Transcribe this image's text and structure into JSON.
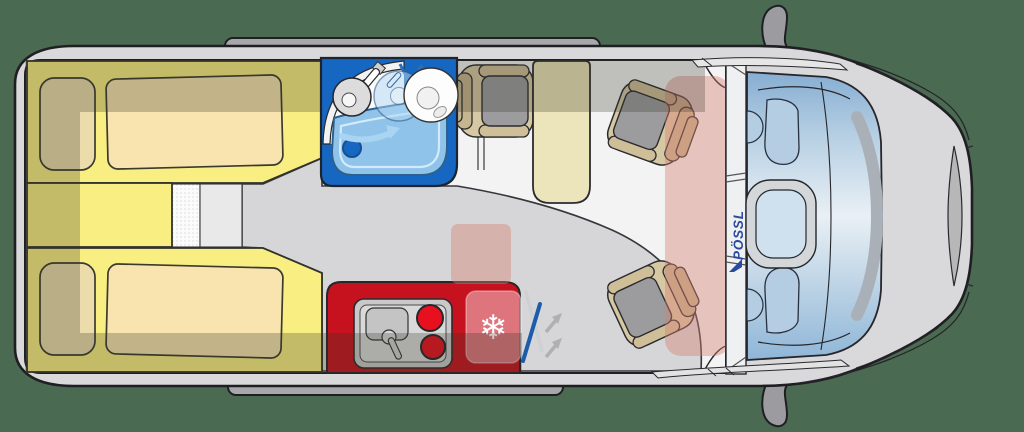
{
  "branding": {
    "logo": "PÖSSL",
    "logo_color": "#2b4a9e"
  },
  "scene": {
    "type": "campervan-floorplan-top-view",
    "facing": "front-of-vehicle-right",
    "features": [
      "two-single-beds",
      "bathroom-with-swivel-wall",
      "shower-tray",
      "toilet",
      "washbasin",
      "kitchenette-two-burner-hob-and-sink",
      "fridge",
      "entry-door-swing",
      "half-dinette-bench",
      "table",
      "swiveled-passenger-seat",
      "swiveled-driver-seat",
      "cab-dashboard",
      "steering-wheel"
    ]
  },
  "icons": {
    "snowflake": "❄",
    "swivel_arrow": "curved-arrow-right",
    "door_swing": "double-swing-arrows"
  },
  "counts": {
    "beds": 2,
    "seats": 3,
    "burners": 2
  },
  "palette": {
    "bg": "#4a6a52",
    "body": "#d9d9db",
    "body_line": "#1f1f23",
    "rail": "#a8a8aa",
    "mirror": "#9c9ca0",
    "floor": "#f3f3f4",
    "walkway": "#d6d6d8",
    "panel": "#e9e9ea",
    "mat": "#fbfbfb",
    "band": "rgba(52,52,38,0.27)",
    "bed": "#f9ee82",
    "mattress": "#f9e3ae",
    "pillow": "#ecdcab",
    "seat_shell": "#d7c8a4",
    "seat_arm": "#cfbf98",
    "seat_back": "#c6b690",
    "seat_cushion": "#9c9c9f",
    "table": "#ece4ba",
    "bath": "#1567c1",
    "shower": "#8fc3e9",
    "shower_edge": "#2d608f",
    "shower_inner": "#d3eaf8",
    "water_arrow": "#a9d5f3",
    "toilet": "#dcdcdc",
    "kitchen": "#c6121f",
    "burner": "#e8101f",
    "steel": "#c9c9c9",
    "fridge_glass": "rgba(255,255,255,0.42)",
    "salmon": "rgba(214,128,115,0.42)",
    "door_blue": "#1c5cab",
    "arrow_grey": "#b0b0b3",
    "pillar": "#eef0f1",
    "logo": "#2b4a9e",
    "dash1": "#86add2",
    "dash2": "#e9f0f5",
    "dash3": "#8fb6d8",
    "vent": "#b5cde2",
    "wheelring": "#d3d7da",
    "wheelinner": "#cfe0ee",
    "crescent": "#aab0b8",
    "grille": "#b7b7b7"
  }
}
